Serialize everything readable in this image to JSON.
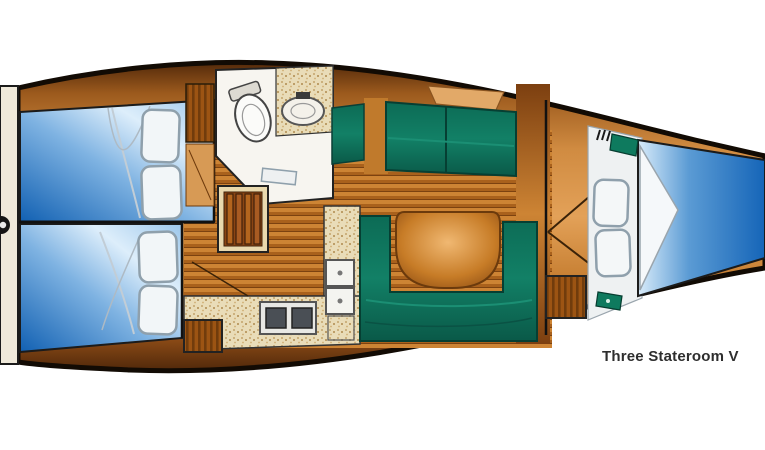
{
  "caption": {
    "text": "Three Stateroom V"
  },
  "diagram": {
    "type": "sailboat-interior-floor-plan",
    "orientation": "bow-right-stern-left-cut-at-image-edges",
    "features": [
      "aft-stateroom-top",
      "aft-stateroom-bottom",
      "transom-platform",
      "head-with-toilet-and-sink",
      "hanging-locker",
      "companionway-steps",
      "galley-with-stove-and-double-sink",
      "upper-settee-with-table",
      "u-shaped-settee-with-round-table",
      "forward-v-berth-stateroom",
      "forward-louvered-cabinet"
    ],
    "colors": {
      "background": "#ffffff",
      "hull_outline": "#120b04",
      "wood_dark": "#53290a",
      "wood_mid": "#c07a2c",
      "wood_light": "#e3a158",
      "plank_light": "#cd8434",
      "plank_dark": "#a9611c",
      "bed_blue_deep": "#1160b2",
      "bed_blue_light": "#ddeefb",
      "upholstery_teal": "#0e7a5e",
      "counter_tan": "#e9dcb8",
      "fixture_white": "#f6f6f2",
      "transom_cream": "#efe9da",
      "caption_color": "#2e2e2e"
    }
  }
}
